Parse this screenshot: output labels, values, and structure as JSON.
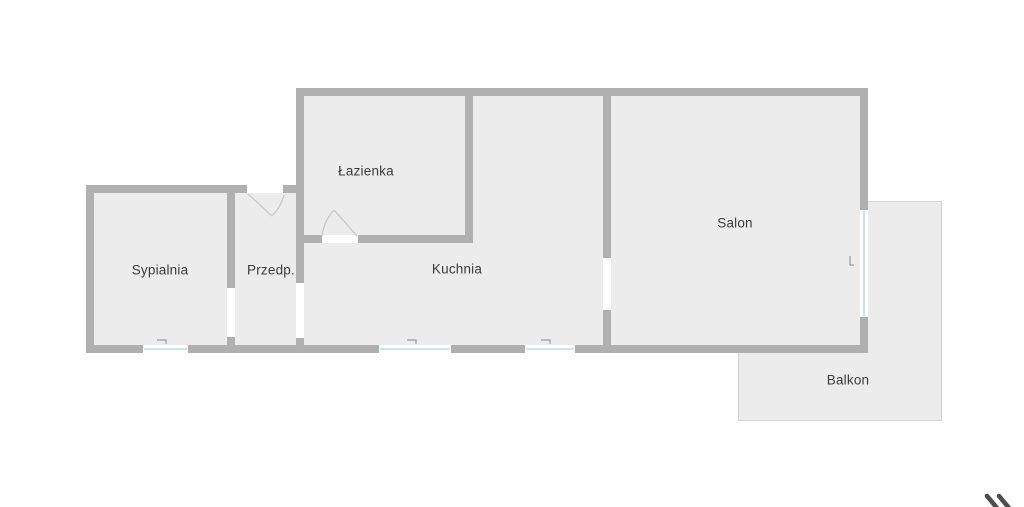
{
  "page": {
    "title": "Rzut mieszkania",
    "background": "#ffffff"
  },
  "floorplan": {
    "type": "floor-plan",
    "canvas": {
      "width": 1024,
      "height": 507
    },
    "colors": {
      "wall": "#b0b0b0",
      "floor": "#ececec",
      "opening": "#ffffff",
      "window_fill": "#ffffff",
      "window_glass": "#cce4ee",
      "balcony_fill": "#ececec",
      "balcony_border": "#d4d4d4",
      "door_line": "#cacaca",
      "handle_line": "#9b9b9b",
      "label_text": "#3b3b3b",
      "watermark": "#4d4d4d"
    },
    "rooms": [
      {
        "id": "lazienka",
        "label": "Łazienka",
        "cx": 366,
        "cy": 171
      },
      {
        "id": "salon",
        "label": "Salon",
        "cx": 735,
        "cy": 223
      },
      {
        "id": "sypialnia",
        "label": "Sypialnia",
        "cx": 160,
        "cy": 270
      },
      {
        "id": "przedpokoj",
        "label": "Przedp.",
        "cx": 271,
        "cy": 270
      },
      {
        "id": "kuchnia",
        "label": "Kuchnia",
        "cx": 457,
        "cy": 269
      },
      {
        "id": "balkon",
        "label": "Balkon",
        "cx": 848,
        "cy": 380
      }
    ],
    "balcony": {
      "x": 738,
      "y": 201,
      "w": 204,
      "h": 220
    },
    "floors": [
      {
        "x": 304,
        "y": 96,
        "w": 556,
        "h": 249
      },
      {
        "x": 94,
        "y": 193,
        "w": 210,
        "h": 152
      }
    ],
    "walls": [
      {
        "x": 296,
        "y": 88,
        "w": 572,
        "h": 8
      },
      {
        "x": 860,
        "y": 88,
        "w": 8,
        "h": 265
      },
      {
        "x": 86,
        "y": 345,
        "w": 782,
        "h": 8
      },
      {
        "x": 86,
        "y": 185,
        "w": 8,
        "h": 168
      },
      {
        "x": 86,
        "y": 185,
        "w": 161,
        "h": 8
      },
      {
        "x": 283,
        "y": 185,
        "w": 21,
        "h": 8
      },
      {
        "x": 296,
        "y": 96,
        "w": 8,
        "h": 187
      },
      {
        "x": 296,
        "y": 338,
        "w": 8,
        "h": 7
      },
      {
        "x": 227,
        "y": 193,
        "w": 8,
        "h": 95
      },
      {
        "x": 227,
        "y": 337,
        "w": 8,
        "h": 8
      },
      {
        "x": 465,
        "y": 96,
        "w": 8,
        "h": 139
      },
      {
        "x": 296,
        "y": 235,
        "w": 26,
        "h": 8
      },
      {
        "x": 358,
        "y": 235,
        "w": 115,
        "h": 8
      },
      {
        "x": 603,
        "y": 96,
        "w": 8,
        "h": 162
      },
      {
        "x": 603,
        "y": 310,
        "w": 8,
        "h": 35
      }
    ],
    "openings": [
      {
        "x": 227,
        "y": 288,
        "w": 8,
        "h": 49
      },
      {
        "x": 296,
        "y": 283,
        "w": 8,
        "h": 55
      },
      {
        "x": 603,
        "y": 258,
        "w": 8,
        "h": 52
      },
      {
        "x": 247,
        "y": 185,
        "w": 36,
        "h": 8
      },
      {
        "x": 322,
        "y": 235,
        "w": 36,
        "h": 8
      }
    ],
    "windows": [
      {
        "x": 143,
        "y": 345,
        "w": 45,
        "h": 8,
        "orient": "h"
      },
      {
        "x": 379,
        "y": 345,
        "w": 72,
        "h": 8,
        "orient": "h"
      },
      {
        "x": 525,
        "y": 345,
        "w": 50,
        "h": 8,
        "orient": "h"
      },
      {
        "x": 860,
        "y": 210,
        "w": 8,
        "h": 107,
        "orient": "v"
      }
    ],
    "doors": [
      {
        "id": "entrance-door",
        "leaf": "M248,194 L272,216",
        "swing": "M272,216 Q281,207 284,195"
      },
      {
        "id": "bathroom-door",
        "leaf": "M357,236 L334,210",
        "swing": "M334,210 Q324,221 322,236"
      }
    ],
    "handles": [
      {
        "path": "M157,340 L166,340 L166,344"
      },
      {
        "path": "M407,340 L416,340 L416,344"
      },
      {
        "path": "M541,340 L550,340 L550,344"
      },
      {
        "path": "M850,256 L850,265 L854,265"
      }
    ],
    "watermark": {
      "strokes": [
        "M987,496 L997,508",
        "M999,496 L1009,508"
      ],
      "width": 4.5
    }
  }
}
